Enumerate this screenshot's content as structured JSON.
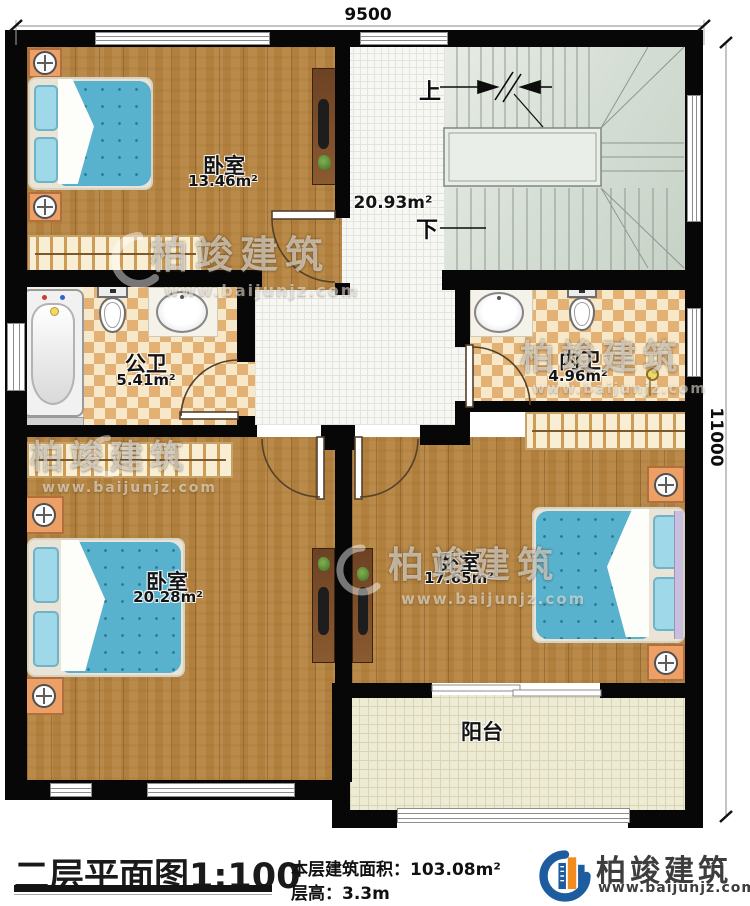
{
  "dimensions": {
    "width_mm": "9500",
    "height_mm": "11000"
  },
  "rooms": {
    "bedroom_top": {
      "name": "卧室",
      "area": "13.46m²"
    },
    "hall": {
      "area": "20.93m²"
    },
    "bath_public": {
      "name": "公卫",
      "area": "5.41m²"
    },
    "bath_private": {
      "name": "内卫",
      "area": "4.96m²"
    },
    "bedroom_left": {
      "name": "卧室",
      "area": "20.28m²"
    },
    "bedroom_right": {
      "name": "卧室",
      "area": "17.65m²"
    },
    "balcony": {
      "name": "阳台"
    }
  },
  "stairs": {
    "up_label": "上",
    "down_label": "下"
  },
  "watermark": {
    "brand": "柏竣建筑",
    "url": "www.baijunjz.com"
  },
  "title_block": {
    "plan_title": "二层平面图",
    "plan_scale": "1:100",
    "area_label": "本层建筑面积：",
    "area_value": "103.08m²",
    "height_label": "层高：",
    "height_value": "3.3m",
    "brand": "柏竣建筑",
    "brand_url": "www.baijunjz.com"
  },
  "colors": {
    "wall": "#070707",
    "wood": "#b1803e",
    "bed": "#58b2ce",
    "brand_blue": "#1d5c9f",
    "brand_orange": "#f28c1e"
  }
}
